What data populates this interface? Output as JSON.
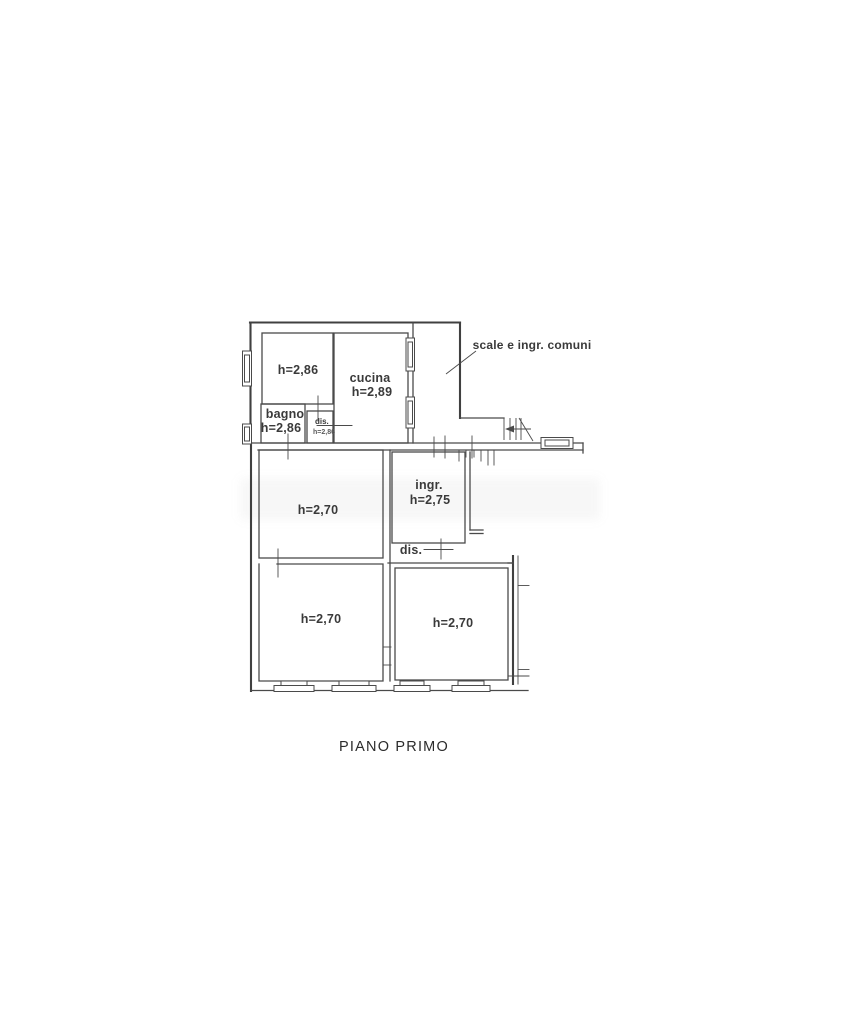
{
  "drawing": {
    "line_color": "#4a4a4a",
    "text_color": "#3a3a3a",
    "title": "PIANO PRIMO",
    "annotation": "scale e ingr. comuni",
    "rooms": {
      "room_top_left": {
        "height": "h=2,86"
      },
      "bagno": {
        "name": "bagno",
        "height": "h=2,86"
      },
      "dis_small": {
        "name": "dis.",
        "height": "h=2,86"
      },
      "cucina": {
        "name": "cucina",
        "height": "h=2,89"
      },
      "ingresso": {
        "name": "ingr.",
        "height": "h=2,75"
      },
      "dis_corridor": {
        "name": "dis."
      },
      "room_mid_left": {
        "height": "h=2,70"
      },
      "room_bottom_left": {
        "height": "h=2,70"
      },
      "room_bottom_right": {
        "height": "h=2,70"
      }
    }
  }
}
